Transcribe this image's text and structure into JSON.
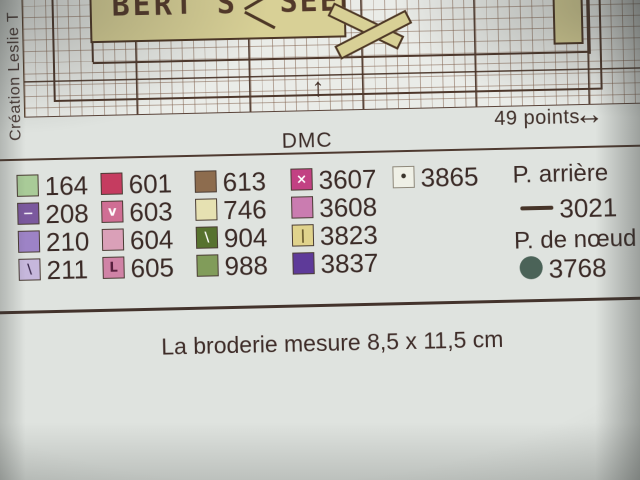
{
  "page": {
    "credit": "Création Leslie T",
    "banner": {
      "word_left": "BERT'S",
      "word_right": "SEED"
    },
    "grid_width_label": "49 points",
    "up_arrow": "↑",
    "left_right_arrow": "↔",
    "brand": "DMC",
    "footer": "La broderie mesure 8,5 x 11,5 cm"
  },
  "legend": {
    "entries": [
      {
        "code": "164",
        "color": "#a9cb98",
        "symbol": "",
        "symbol_color": "",
        "col": 0,
        "row": 0
      },
      {
        "code": "208",
        "color": "#7b599e",
        "symbol": "−",
        "symbol_color": "#f2eef6",
        "col": 0,
        "row": 1
      },
      {
        "code": "210",
        "color": "#9d83c6",
        "symbol": "",
        "symbol_color": "",
        "col": 0,
        "row": 2
      },
      {
        "code": "211",
        "color": "#c6b7dc",
        "symbol": "\\",
        "symbol_color": "#3c2b4e",
        "col": 0,
        "row": 3
      },
      {
        "code": "601",
        "color": "#c53c60",
        "symbol": "",
        "symbol_color": "",
        "col": 1,
        "row": 0
      },
      {
        "code": "603",
        "color": "#d06e94",
        "symbol": "v",
        "symbol_color": "#ffffff",
        "col": 1,
        "row": 1
      },
      {
        "code": "604",
        "color": "#daa0b8",
        "symbol": "",
        "symbol_color": "",
        "col": 1,
        "row": 2
      },
      {
        "code": "605",
        "color": "#d083a6",
        "symbol": "L",
        "symbol_color": "#58203e",
        "col": 1,
        "row": 3
      },
      {
        "code": "613",
        "color": "#8d6c4e",
        "symbol": "",
        "symbol_color": "",
        "col": 2,
        "row": 0
      },
      {
        "code": "746",
        "color": "#e6e1b2",
        "symbol": "",
        "symbol_color": "",
        "col": 2,
        "row": 1
      },
      {
        "code": "904",
        "color": "#57722f",
        "symbol": "\\",
        "symbol_color": "#ffffff",
        "col": 2,
        "row": 2
      },
      {
        "code": "988",
        "color": "#819c5a",
        "symbol": "",
        "symbol_color": "",
        "col": 2,
        "row": 3
      },
      {
        "code": "3607",
        "color": "#c24183",
        "symbol": "×",
        "symbol_color": "#ffffff",
        "col": 3,
        "row": 0
      },
      {
        "code": "3608",
        "color": "#ca7cb0",
        "symbol": "",
        "symbol_color": "",
        "col": 3,
        "row": 1
      },
      {
        "code": "3823",
        "color": "#e0d38c",
        "symbol": "|",
        "symbol_color": "#5a4a20",
        "col": 3,
        "row": 2
      },
      {
        "code": "3837",
        "color": "#5e3a99",
        "symbol": "",
        "symbol_color": "",
        "col": 3,
        "row": 3
      },
      {
        "code": "3865",
        "color": "#eff0e6",
        "symbol": "•",
        "symbol_color": "#3a342c",
        "col": 4,
        "row": 0
      }
    ],
    "backstitch": {
      "label": "P. arrière",
      "code": "3021",
      "color": "#463428"
    },
    "french_knot": {
      "label": "P. de nœud",
      "code": "3768",
      "color": "#4b6358"
    }
  }
}
